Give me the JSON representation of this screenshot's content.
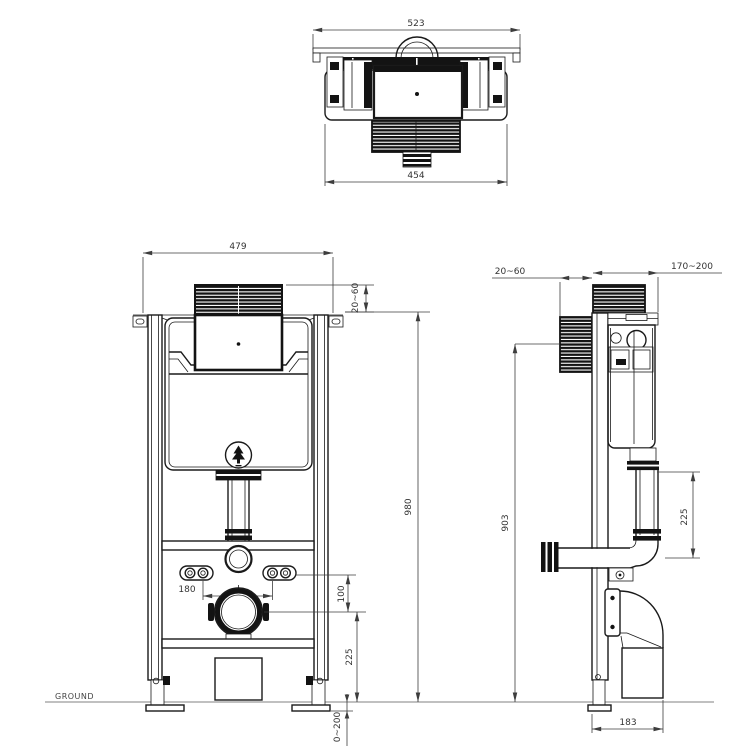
{
  "drawing": {
    "ground_label": "GROUND",
    "colors": {
      "line": "#1a1a1a",
      "dimension": "#3d3d3d",
      "ground_line": "#9a9a9a",
      "background": "#ffffff",
      "hatch_fill": "#131313"
    },
    "top_view": {
      "overall_width": "523",
      "body_width": "454"
    },
    "front_view": {
      "frame_width": "479",
      "cover_protrusion": "20~60",
      "frame_height": "980",
      "pan_bolt_spacing": "180",
      "bolt_to_outlet": "100",
      "outlet_center_height": "225",
      "leg_adjustment": "0~200"
    },
    "side_view": {
      "cover_protrusion": "20~60",
      "frame_depth": "170~200",
      "flush_plate_center_height": "903",
      "tank_to_flush_bend": "225",
      "outlet_bend_depth": "183"
    }
  }
}
